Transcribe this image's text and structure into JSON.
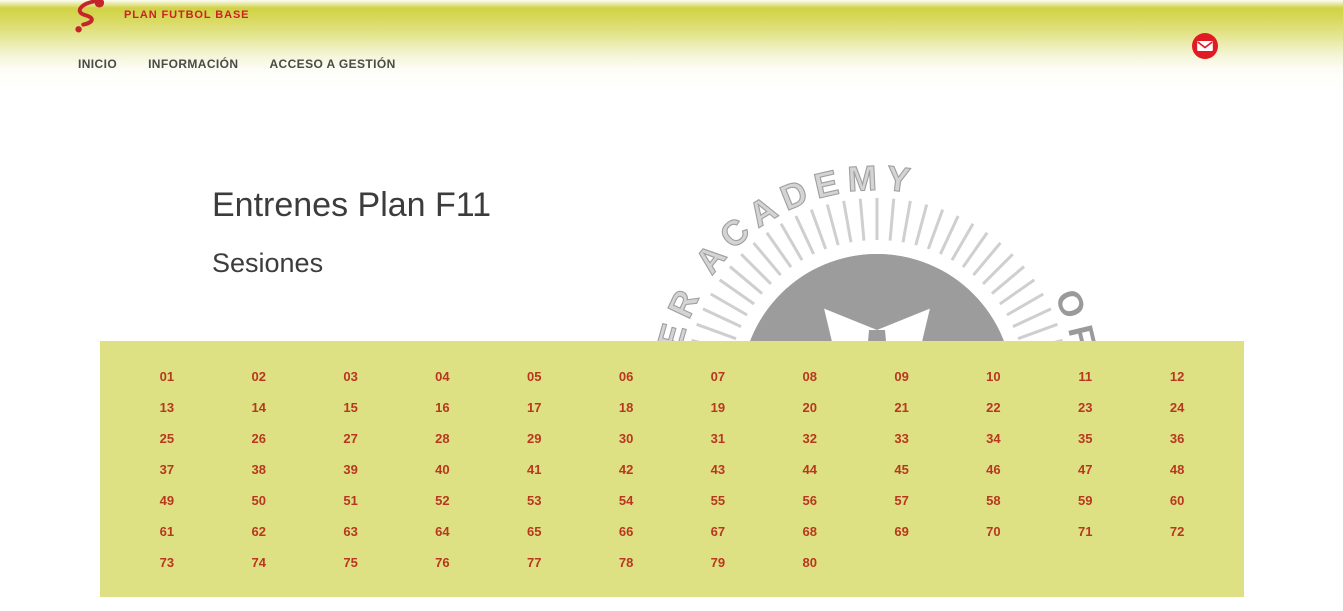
{
  "brand": {
    "name": "PLAN FUTBOL BASE"
  },
  "nav": {
    "items": [
      {
        "label": "INICIO"
      },
      {
        "label": "INFORMACIÓN"
      },
      {
        "label": "ACCESO A GESTIÓN"
      }
    ]
  },
  "main": {
    "title": "Entrenes Plan F11",
    "subtitle": "Sesiones"
  },
  "watermark": {
    "text_left": "SOCCER ACADEMY",
    "text_right": " OF SPAIN"
  },
  "sessions": [
    "01",
    "02",
    "03",
    "04",
    "05",
    "06",
    "07",
    "08",
    "09",
    "10",
    "11",
    "12",
    "13",
    "14",
    "15",
    "16",
    "17",
    "18",
    "19",
    "20",
    "21",
    "22",
    "23",
    "24",
    "25",
    "26",
    "27",
    "28",
    "29",
    "30",
    "31",
    "32",
    "33",
    "34",
    "35",
    "36",
    "37",
    "38",
    "39",
    "40",
    "41",
    "42",
    "43",
    "44",
    "45",
    "46",
    "47",
    "48",
    "49",
    "50",
    "51",
    "52",
    "53",
    "54",
    "55",
    "56",
    "57",
    "58",
    "59",
    "60",
    "61",
    "62",
    "63",
    "64",
    "65",
    "66",
    "67",
    "68",
    "69",
    "70",
    "71",
    "72",
    "73",
    "74",
    "75",
    "76",
    "77",
    "78",
    "79",
    "80"
  ],
  "colors": {
    "accent_red": "#cc2127",
    "session_link_red": "#b8371f",
    "panel_yellow": "#dee183",
    "header_yellow": "#d1d246",
    "nav_text": "#4a4a46",
    "watermark_gray": "#9a9a9a"
  }
}
